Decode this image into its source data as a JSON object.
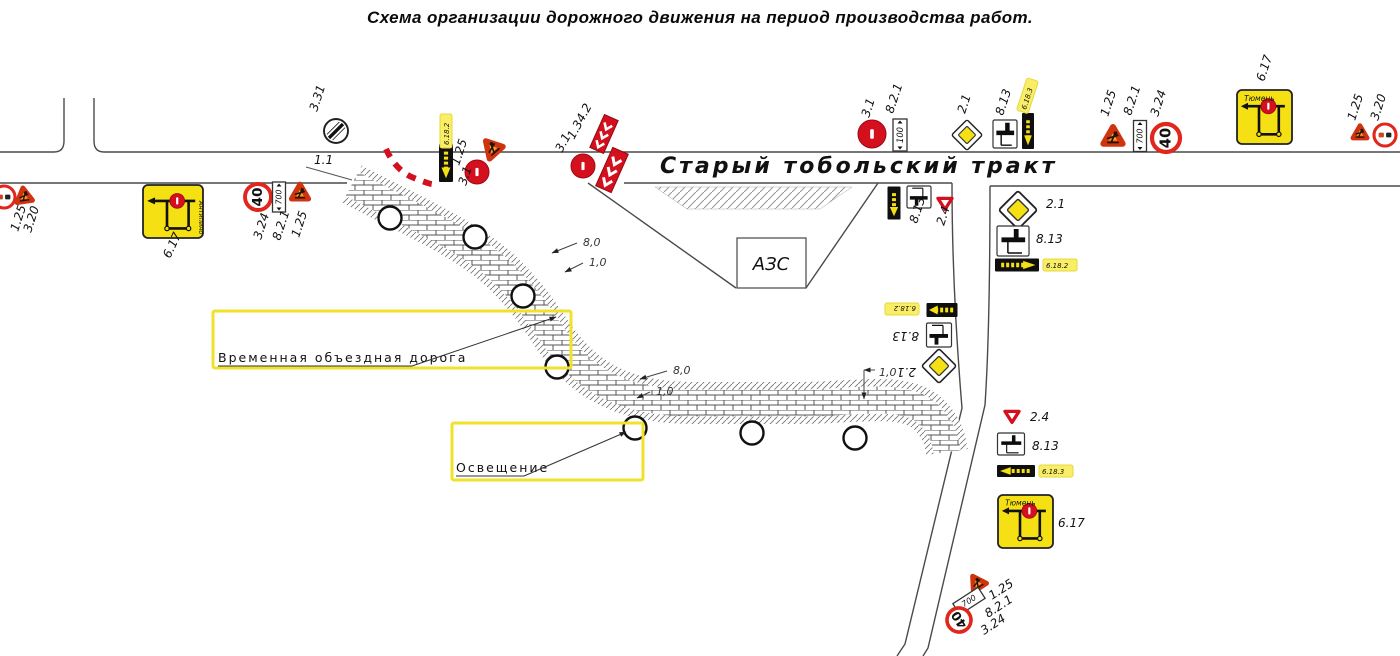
{
  "title": "Схема организации дорожного движения на период производства работ.",
  "road": {
    "name": "Старый тобольский тракт",
    "marking_label": "1.1"
  },
  "azs": {
    "label": "АЗС"
  },
  "callouts": {
    "bypass": {
      "text": "Временная объездная дорога"
    },
    "lighting": {
      "text": "Освещение"
    }
  },
  "colors": {
    "sign_yellow": "#f5e013",
    "sign_red": "#d40f1e",
    "work_orange": "#f5a12d",
    "work_border": "#cf3410",
    "highlight": "#f9ee66",
    "line": "#4a4a4a"
  },
  "lighting_poles": [
    [
      390,
      218
    ],
    [
      475,
      237
    ],
    [
      523,
      296
    ],
    [
      557,
      367
    ],
    [
      635,
      428
    ],
    [
      752,
      433
    ],
    [
      855,
      438
    ]
  ],
  "dimensions": [
    {
      "t": "8,0",
      "x": 583,
      "y": 246,
      "lead": [
        577,
        243,
        552,
        253
      ]
    },
    {
      "t": "1,0",
      "x": 589,
      "y": 266,
      "lead": [
        583,
        263,
        565,
        272
      ]
    },
    {
      "t": "8,0",
      "x": 673,
      "y": 374,
      "lead": [
        667,
        371,
        640,
        379
      ]
    },
    {
      "t": "1,0",
      "x": 656,
      "y": 395,
      "lead": [
        650,
        392,
        637,
        398
      ]
    },
    {
      "t": "1,0",
      "x": 879,
      "y": 376,
      "lead": [
        875,
        370,
        864,
        370
      ],
      "lead2": [
        864,
        370,
        864,
        399
      ]
    }
  ],
  "sign_labels": [
    {
      "t": "1.25",
      "x": 18,
      "y": 232,
      "r": -72
    },
    {
      "t": "3.20",
      "x": 31,
      "y": 233,
      "r": -72
    },
    {
      "t": "6.17",
      "x": 170,
      "y": 259,
      "r": -65
    },
    {
      "t": "3.24",
      "x": 261,
      "y": 240,
      "r": -72
    },
    {
      "t": "8.2.1",
      "x": 280,
      "y": 241,
      "r": -72
    },
    {
      "t": "1.25",
      "x": 299,
      "y": 238,
      "r": -72
    },
    {
      "t": "3.31",
      "x": 317,
      "y": 112,
      "r": -72
    },
    {
      "t": "1.1",
      "x": 314,
      "y": 164,
      "r": 0
    },
    {
      "t": "6.18.2",
      "x": 449,
      "y": 145,
      "r": -90,
      "hl": 1,
      "size": 7
    },
    {
      "t": "1.25",
      "x": 459,
      "y": 166,
      "r": -72
    },
    {
      "t": "3.1",
      "x": 466,
      "y": 186,
      "r": -72
    },
    {
      "t": "3.1",
      "x": 562,
      "y": 153,
      "r": -62
    },
    {
      "t": "1.34.2",
      "x": 574,
      "y": 140,
      "r": -62
    },
    {
      "t": "3.1",
      "x": 869,
      "y": 118,
      "r": -72
    },
    {
      "t": "8.2.1",
      "x": 893,
      "y": 114,
      "r": -72
    },
    {
      "t": "2.1",
      "x": 965,
      "y": 114,
      "r": -72
    },
    {
      "t": "8.13",
      "x": 1003,
      "y": 116,
      "r": -72
    },
    {
      "t": "6.18.3",
      "x": 1026,
      "y": 110,
      "r": -72,
      "hl": 1,
      "size": 7
    },
    {
      "t": "1.25",
      "x": 1108,
      "y": 117,
      "r": -72
    },
    {
      "t": "8.2.1",
      "x": 1131,
      "y": 116,
      "r": -72
    },
    {
      "t": "3.24",
      "x": 1158,
      "y": 117,
      "r": -72
    },
    {
      "t": "6.17",
      "x": 1264,
      "y": 82,
      "r": -72
    },
    {
      "t": "1.25",
      "x": 1355,
      "y": 121,
      "r": -72
    },
    {
      "t": "3.20",
      "x": 1378,
      "y": 121,
      "r": -72
    },
    {
      "t": "8.13",
      "x": 917,
      "y": 224,
      "r": -72
    },
    {
      "t": "2.4",
      "x": 944,
      "y": 226,
      "r": -72
    },
    {
      "t": "2.1",
      "x": 1046,
      "y": 208,
      "r": 0
    },
    {
      "t": "8.13",
      "x": 1036,
      "y": 243,
      "r": 0
    },
    {
      "t": "6.18.2",
      "x": 1046,
      "y": 268,
      "r": 0,
      "hl": 1,
      "size": 7
    },
    {
      "t": "6.18.2",
      "x": 916,
      "y": 306,
      "r": 180,
      "hl": 1,
      "size": 7
    },
    {
      "t": "8.13",
      "x": 919,
      "y": 332,
      "r": 180
    },
    {
      "t": "2.1",
      "x": 916,
      "y": 368,
      "r": 180
    },
    {
      "t": "2.4",
      "x": 1030,
      "y": 421,
      "r": 0
    },
    {
      "t": "8.13",
      "x": 1032,
      "y": 450,
      "r": 0
    },
    {
      "t": "6.18.3",
      "x": 1042,
      "y": 474,
      "r": 0,
      "hl": 1,
      "size": 7
    },
    {
      "t": "6.17",
      "x": 1058,
      "y": 527,
      "r": 0
    },
    {
      "t": "1.25",
      "x": 992,
      "y": 600,
      "r": -33
    },
    {
      "t": "8.2.1",
      "x": 988,
      "y": 618,
      "r": -33
    },
    {
      "t": "3.24",
      "x": 984,
      "y": 635,
      "r": -33
    }
  ],
  "signs": [
    {
      "y2": "no-overtaking",
      "type": "c320",
      "x": 4,
      "y": 197,
      "s": 11
    },
    {
      "y2": "roadworks",
      "type": "t125",
      "x": 24,
      "y": 196,
      "s": 13,
      "rot": -8
    },
    {
      "y2": "detour-scheme",
      "type": "s617",
      "x": 143,
      "y": 185,
      "w": 60,
      "h": 53,
      "txt": "Антипино",
      "vert": 1
    },
    {
      "y2": "speed-40",
      "type": "c324",
      "x": 258,
      "y": 197,
      "s": 13,
      "txt": "40"
    },
    {
      "y2": "plate-distance",
      "type": "p821",
      "x": 279,
      "y": 197,
      "w": 13,
      "h": 30,
      "txt": "700"
    },
    {
      "y2": "roadworks",
      "type": "t125",
      "x": 300,
      "y": 193,
      "s": 14
    },
    {
      "y2": "end-restrictions",
      "type": "c331",
      "x": 336,
      "y": 131,
      "s": 12
    },
    {
      "y2": "detour-arrow",
      "type": "p6182v",
      "x": 446,
      "y": 163,
      "w": 14,
      "h": 38
    },
    {
      "y2": "roadworks",
      "type": "t125",
      "x": 492,
      "y": 148,
      "s": 15,
      "rot": -42
    },
    {
      "y2": "no-entry",
      "type": "c31",
      "x": 477,
      "y": 172,
      "s": 12
    },
    {
      "y2": "chevron",
      "type": "chev",
      "x": 604,
      "y": 134,
      "w": 15,
      "h": 36,
      "rot": 24
    },
    {
      "y2": "chevron",
      "type": "chev",
      "x": 612,
      "y": 170,
      "w": 17,
      "h": 42,
      "rot": 24
    },
    {
      "y2": "no-entry",
      "type": "c31",
      "x": 583,
      "y": 166,
      "s": 12
    },
    {
      "y2": "no-entry",
      "type": "c31",
      "x": 872,
      "y": 134,
      "s": 14
    },
    {
      "y2": "plate-distance",
      "type": "p821",
      "x": 900,
      "y": 135,
      "w": 14,
      "h": 32,
      "txt": "100"
    },
    {
      "y2": "priority-road",
      "type": "d21",
      "x": 967,
      "y": 135,
      "s": 16
    },
    {
      "y2": "plate-direction",
      "type": "p813",
      "x": 1005,
      "y": 134,
      "w": 24,
      "h": 28
    },
    {
      "y2": "detour-arrow",
      "type": "p6183v",
      "x": 1028,
      "y": 131,
      "w": 12,
      "h": 36
    },
    {
      "y2": "roadworks",
      "type": "t125",
      "x": 1113,
      "y": 137,
      "s": 16
    },
    {
      "y2": "plate-distance",
      "type": "p821",
      "x": 1140,
      "y": 136,
      "w": 13,
      "h": 31,
      "txt": "700"
    },
    {
      "y2": "speed-40",
      "type": "c324",
      "x": 1166,
      "y": 138,
      "s": 14,
      "txt": "40"
    },
    {
      "y2": "detour-scheme",
      "type": "s617",
      "x": 1237,
      "y": 90,
      "w": 55,
      "h": 54,
      "txt": "Тюмень"
    },
    {
      "y2": "roadworks",
      "type": "t125",
      "x": 1360,
      "y": 133,
      "s": 12
    },
    {
      "y2": "no-overtaking",
      "type": "c320",
      "x": 1385,
      "y": 135,
      "s": 11
    },
    {
      "y2": "detour-arrow",
      "type": "p6182v",
      "x": 894,
      "y": 203,
      "w": 13,
      "h": 33
    },
    {
      "y2": "plate-direction",
      "type": "p813",
      "x": 919,
      "y": 197,
      "w": 24,
      "h": 22,
      "rot": 180
    },
    {
      "y2": "give-way",
      "type": "t24",
      "x": 945,
      "y": 203,
      "s": 11
    },
    {
      "y2": "priority-road",
      "type": "d21",
      "x": 1018,
      "y": 210,
      "s": 20
    },
    {
      "y2": "plate-direction",
      "type": "p813",
      "x": 1013,
      "y": 241,
      "w": 32,
      "h": 30
    },
    {
      "y2": "detour-arrow",
      "type": "p6182h",
      "x": 1017,
      "y": 265,
      "w": 44,
      "h": 13,
      "dir": 1
    },
    {
      "y2": "detour-arrow",
      "type": "p6182h",
      "x": 942,
      "y": 310,
      "w": 31,
      "h": 14,
      "dir": -1
    },
    {
      "y2": "plate-direction",
      "type": "p813",
      "x": 939,
      "y": 335,
      "w": 25,
      "h": 24,
      "rot": 180
    },
    {
      "y2": "priority-road",
      "type": "d21",
      "x": 939,
      "y": 366,
      "s": 18
    },
    {
      "y2": "give-way",
      "type": "t24",
      "x": 1012,
      "y": 416,
      "s": 11
    },
    {
      "y2": "plate-direction",
      "type": "p813",
      "x": 1011,
      "y": 444,
      "w": 27,
      "h": 22
    },
    {
      "y2": "detour-arrow",
      "type": "p6183h",
      "x": 1016,
      "y": 471,
      "w": 38,
      "h": 12,
      "dir": -1
    },
    {
      "y2": "detour-scheme",
      "type": "s617",
      "x": 998,
      "y": 495,
      "w": 55,
      "h": 53,
      "txt": "Тюмень"
    },
    {
      "y2": "roadworks",
      "type": "t125",
      "x": 977,
      "y": 583,
      "s": 13,
      "rot": -33
    },
    {
      "y2": "plate-distance",
      "type": "p821h",
      "x": 969,
      "y": 601,
      "w": 30,
      "h": 13,
      "txt": "700",
      "rot": -33
    },
    {
      "y2": "speed-40",
      "type": "c324",
      "x": 959,
      "y": 620,
      "s": 12,
      "txt": "40",
      "rot": -33
    }
  ]
}
